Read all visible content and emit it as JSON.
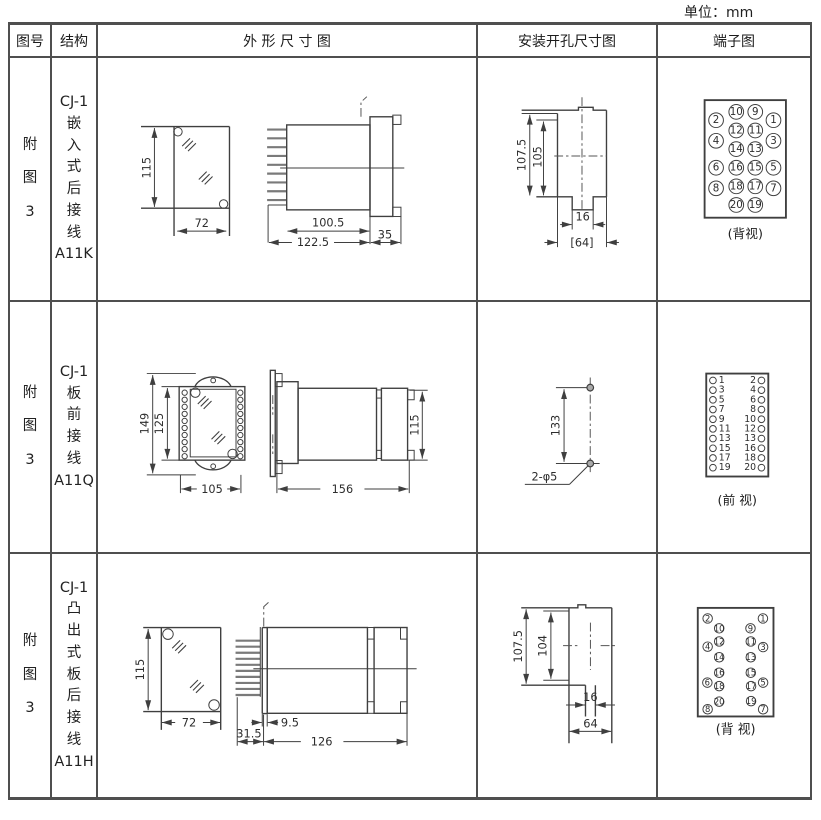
{
  "page": {
    "unit_label": "单位：mm"
  },
  "table": {
    "headers": {
      "fig_no": "图号",
      "structure": "结构",
      "outline": "外 形 尺 寸 图",
      "mounting": "安装开孔尺寸图",
      "terminal": "端子图"
    },
    "rows": [
      {
        "fig_no": "附\n图\n3",
        "structure": {
          "model": "CJ-1",
          "name": "嵌\n入\n式\n后\n接\n线",
          "code": "A11K"
        },
        "outline_dims": {
          "front_height": "115",
          "front_width": "72",
          "body_length": "100.5",
          "total_length": "122.5",
          "flange_depth": "35"
        },
        "mounting_dims": {
          "outer_height": "107.5",
          "inner_height": "105",
          "notch_width": "16",
          "opening_width": "[64]"
        },
        "terminal": {
          "caption": "(背视)",
          "outer_left": [
            "2",
            "4",
            "6",
            "8"
          ],
          "inner_left": [
            "10",
            "12",
            "14",
            "16",
            "18",
            "20"
          ],
          "inner_right": [
            "9",
            "11",
            "13",
            "15",
            "17",
            "19"
          ],
          "outer_right": [
            "1",
            "3",
            "5",
            "7"
          ]
        }
      },
      {
        "fig_no": "附\n图\n3",
        "structure": {
          "model": "CJ-1",
          "name": "板\n前\n接\n线",
          "code": "A11Q"
        },
        "outline_dims": {
          "outer_height": "149",
          "inner_height": "125",
          "front_width": "105",
          "side_length": "156",
          "side_height": "115"
        },
        "mounting_dims": {
          "hole_spacing": "133",
          "holes_label": "2-φ5"
        },
        "terminal": {
          "caption": "(前 视)",
          "left": [
            "1",
            "3",
            "5",
            "7",
            "9",
            "11",
            "13",
            "15",
            "17",
            "19"
          ],
          "right": [
            "2",
            "4",
            "6",
            "8",
            "10",
            "12",
            "13",
            "16",
            "18",
            "20"
          ]
        }
      },
      {
        "fig_no": "附\n图\n3",
        "structure": {
          "model": "CJ-1",
          "name": "凸\n出\n式\n板\n后\n接\n线",
          "code": "A11H"
        },
        "outline_dims": {
          "front_height": "115",
          "front_width": "72",
          "pin_length": "31.5",
          "plate_thickness": "9.5",
          "body_length": "126"
        },
        "mounting_dims": {
          "outer_height": "107.5",
          "inner_height": "104",
          "notch_width": "16",
          "opening_width": "64"
        },
        "terminal": {
          "caption": "(背 视)",
          "outer_left": [
            "2",
            "4",
            "6",
            "8"
          ],
          "inner_left": [
            "10",
            "12",
            "14",
            "16",
            "18",
            "20"
          ],
          "inner_right": [
            "9",
            "11",
            "13",
            "15",
            "17",
            "19"
          ],
          "outer_right": [
            "1",
            "3",
            "5",
            "7"
          ]
        }
      }
    ]
  }
}
